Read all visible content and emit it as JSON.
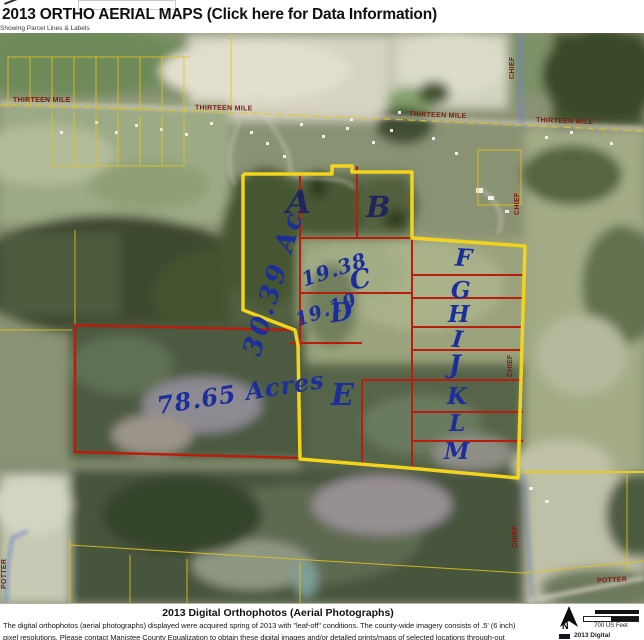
{
  "header": {
    "title": "2013 ORTHO AERIAL MAPS (Click here for Data Information)",
    "subtitle": "Showing Parcel Lines & Labels"
  },
  "roads": {
    "thirteen_mile": "THIRTEEN MILE",
    "chief": "CHIEF",
    "potter": "POTTER"
  },
  "annotations": {
    "parcel_letters": [
      {
        "label": "A"
      },
      {
        "label": "B"
      },
      {
        "label": "C"
      },
      {
        "label": "D"
      },
      {
        "label": "E"
      },
      {
        "label": "F"
      },
      {
        "label": "G"
      },
      {
        "label": "H"
      },
      {
        "label": "I"
      },
      {
        "label": "J"
      },
      {
        "label": "K"
      },
      {
        "label": "L"
      },
      {
        "label": "M"
      }
    ],
    "acreages": [
      {
        "text": "30.39 Ac"
      },
      {
        "text": "19.38"
      },
      {
        "text": "19.19"
      },
      {
        "text": "78.65 Acres"
      }
    ]
  },
  "footer": {
    "caption_title": "2013 Digital Orthophotos (Aerial Photographs)",
    "caption_line1": "The digital orthophotos (aerial photographs) displayed were acquired spring of 2013 with \"leaf-off\" conditions. The county-wide imagery consists of .5' (6 inch)",
    "caption_line2": "pixel resolutions. Please contact Manistee County Equalization to obtain these digital images and/or detailed prints/maps of selected locations through-out"
  },
  "legend": {
    "north_label": "N",
    "scale_label": "700 US Feet",
    "item1": "2013 Digital"
  },
  "colors": {
    "boundary_yellow": "#F2D41C",
    "parcel_red": "#B91D0C",
    "annotation_blue": "#1C2E9B",
    "road_label_red": "#7D1B10",
    "road_blue": "#6E86C8"
  }
}
